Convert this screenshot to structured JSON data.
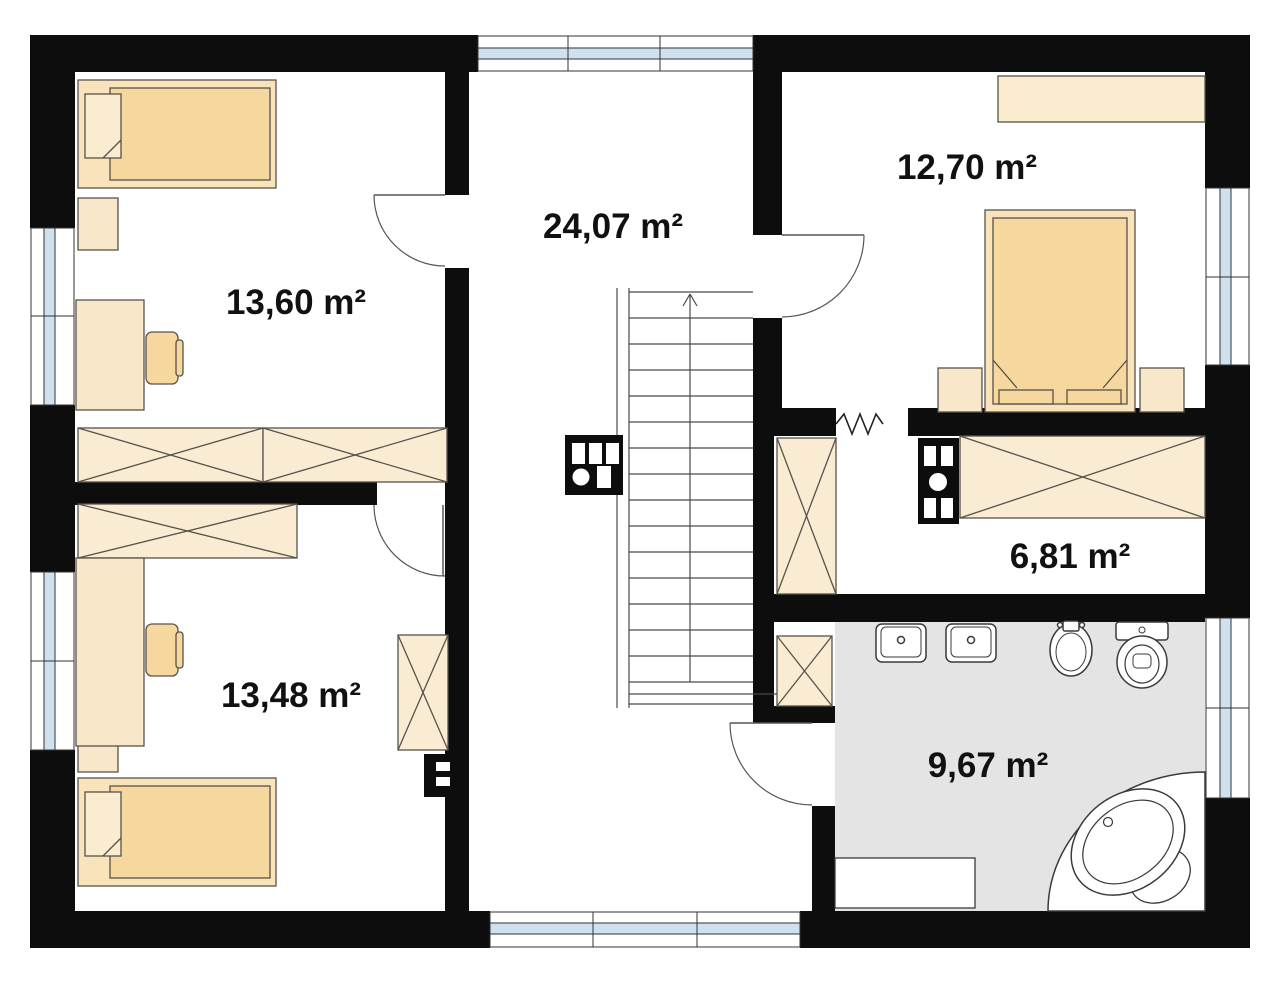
{
  "plan_title": "Floor plan",
  "rooms": [
    {
      "id": "bedroom-top-left",
      "area_label": "13,60 m²"
    },
    {
      "id": "hall",
      "area_label": "24,07 m²"
    },
    {
      "id": "bedroom-top-right",
      "area_label": "12,70 m²"
    },
    {
      "id": "wardrobe-room",
      "area_label": "6,81 m²"
    },
    {
      "id": "bedroom-bottom-left",
      "area_label": "13,48 m²"
    },
    {
      "id": "bathroom",
      "area_label": "9,67 m²"
    }
  ],
  "colors": {
    "wall": "#0d0d0d",
    "furniture_light": "#f9ecd2",
    "furniture_medium": "#f6d79d",
    "furniture_pale": "#faeccf",
    "bathroom_floor": "#e4e4e4",
    "window_glass": "#cfe0ef",
    "outline": "#57524b",
    "fixture_outline": "#3a3a3a",
    "label_text": "#111111"
  }
}
